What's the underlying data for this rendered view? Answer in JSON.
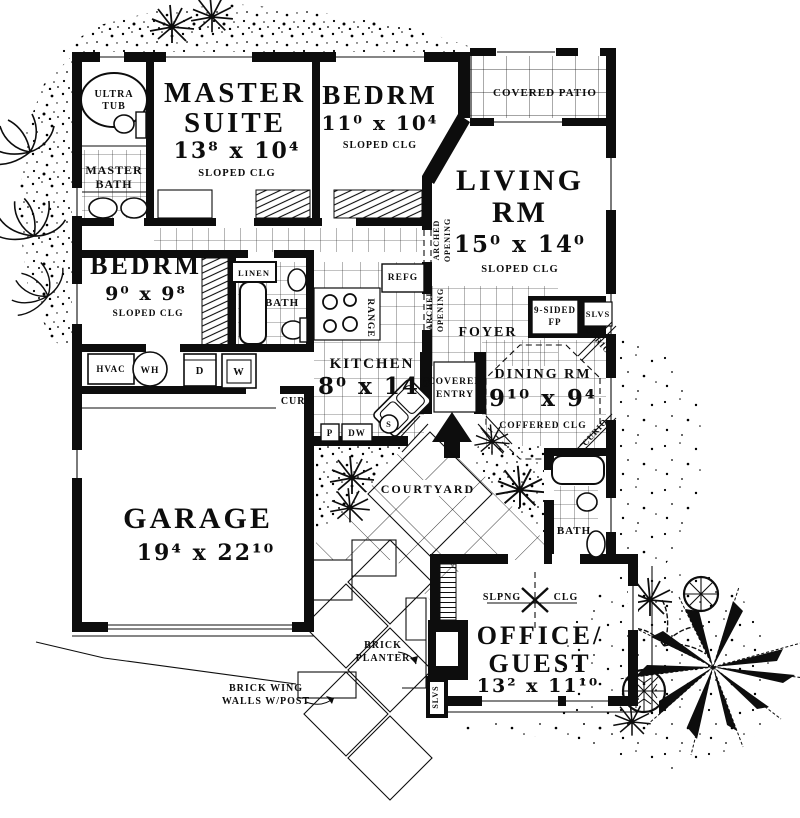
{
  "colors": {
    "ink": "#0d0d0d",
    "paper": "#ffffff"
  },
  "rooms": {
    "ultra_tub": {
      "line1": "ULTRA",
      "line2": "TUB"
    },
    "master_bath": {
      "line1": "MASTER",
      "line2": "BATH"
    },
    "master_suite": {
      "line1": "MASTER",
      "line2": "SUITE",
      "dims": "13⁸ x 10⁴",
      "clg": "SLOPED CLG"
    },
    "bedroom_top": {
      "name": "BEDRM",
      "dims": "11⁰ x 10⁴",
      "clg": "SLOPED CLG"
    },
    "covered_patio": {
      "name": "COVERED PATIO"
    },
    "living": {
      "line1": "LIVING",
      "line2": "RM",
      "dims": "15⁰ x 14⁰",
      "clg": "SLOPED CLG"
    },
    "bedroom_left": {
      "name": "BEDRM",
      "dims": "9⁰ x 9⁸",
      "clg": "SLOPED CLG"
    },
    "bath_mid": {
      "name": "BATH"
    },
    "kitchen": {
      "name": "KITCHEN",
      "dims": "8⁰ x 14⁶"
    },
    "foyer": {
      "name": "FOYER"
    },
    "dining": {
      "name": "DINING RM",
      "dims": "9¹⁰ x 9⁴",
      "clg": "COFFERED CLG"
    },
    "covered_entry": {
      "line1": "COVERED",
      "line2": "ENTRY"
    },
    "garage": {
      "name": "GARAGE",
      "dims": "19⁴ x 22¹⁰"
    },
    "courtyard": {
      "name": "COURTYARD"
    },
    "bath_right": {
      "name": "BATH"
    },
    "office": {
      "line1": "OFFICE/",
      "line2": "GUEST",
      "dims": "13² x 11¹⁰",
      "clg_left": "SLPNG",
      "clg_right": "CLG"
    }
  },
  "fixtures": {
    "linen": "LINEN",
    "refg": "REFG",
    "range": "RANGE",
    "hvac": "HVAC",
    "wh": "WH",
    "dryer": "D",
    "washer": "W",
    "pantry": "P",
    "dishwasher": "DW",
    "sink": "S",
    "fp_line1": "9-SIDED",
    "fp_line2": "FP",
    "slvs": "SLVS",
    "slvs_office": "SLVS",
    "curio_upper": "CURIO",
    "curio_lower": "CURIO"
  },
  "annotations": {
    "curb": "CURB",
    "arched_a1": "ARCHED",
    "arched_a2": "OPENING",
    "arched_b1": "ARCHED",
    "arched_b2": "OPENING",
    "planter1": "BRICK",
    "planter2": "PLANTER",
    "wing1": "BRICK WING",
    "wing2": "WALLS W/POST"
  }
}
